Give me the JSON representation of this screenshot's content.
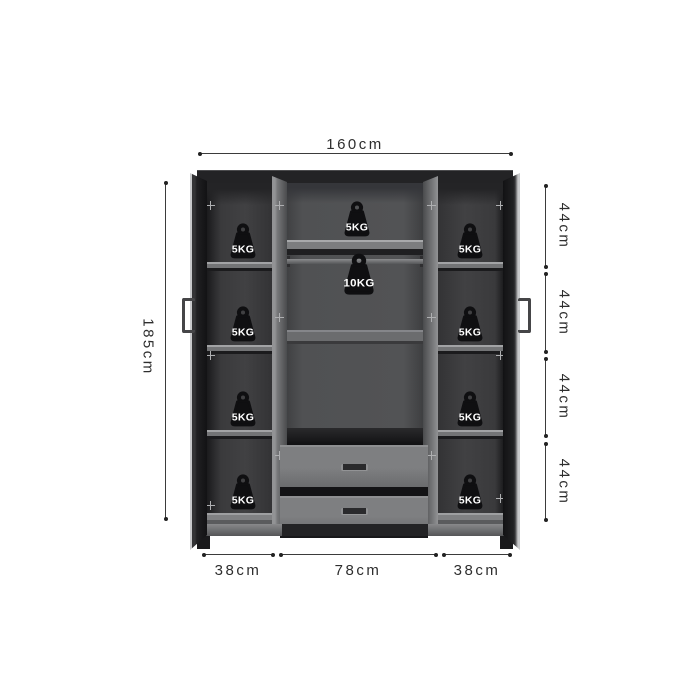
{
  "dimensions": {
    "top_width": "160cm",
    "left_height": "185cm",
    "right_segments": [
      "44cm",
      "44cm",
      "44cm",
      "44cm"
    ],
    "bottom_segments": [
      "38cm",
      "78cm",
      "38cm"
    ]
  },
  "weights": {
    "left_column": [
      "5KG",
      "5KG",
      "5KG",
      "5KG"
    ],
    "center_shelf": "5KG",
    "hanging_rod": "10KG",
    "right_column": [
      "5KG",
      "5KG",
      "5KG",
      "5KG"
    ]
  },
  "colors": {
    "background": "#ffffff",
    "dim_line": "#3b3b3b",
    "dim_text": "#2e2e2e",
    "cabinet_dark": "#232325",
    "interior_side": "#3a3a3c",
    "interior_center": "#4d4e50",
    "shelf_light": "#9a9b9d",
    "drawer_front": "#77787a",
    "weight_fill": "#0f0f11"
  }
}
